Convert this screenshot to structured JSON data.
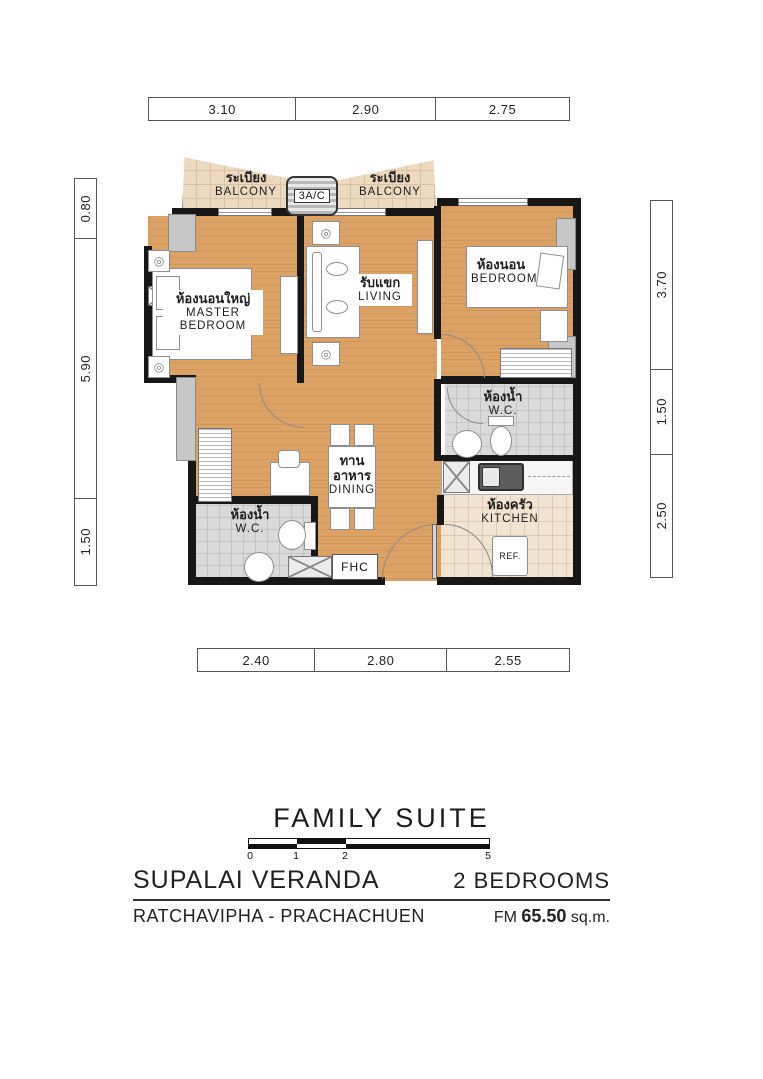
{
  "plan": {
    "rooms": {
      "balcony_left": {
        "thai": "ระเบียง",
        "en": "BALCONY"
      },
      "balcony_right": {
        "thai": "ระเบียง",
        "en": "BALCONY"
      },
      "master_bedroom": {
        "thai": "ห้องนอนใหญ่",
        "en1": "MASTER",
        "en2": "BEDROOM"
      },
      "living": {
        "thai": "รับแขก",
        "en": "LIVING"
      },
      "bedroom": {
        "thai": "ห้องนอน",
        "en": "BEDROOM"
      },
      "wc_upper": {
        "thai": "ห้องน้ำ",
        "en": "W.C."
      },
      "wc_lower": {
        "thai": "ห้องน้ำ",
        "en": "W.C."
      },
      "dining": {
        "thai": "ทานอาหาร",
        "en": "DINING"
      },
      "kitchen": {
        "thai": "ห้องครัว",
        "en": "KITCHEN"
      }
    },
    "labels": {
      "ac": "3A/C",
      "ref": "REF.",
      "fhc": "FHC"
    }
  },
  "dimensions": {
    "top": [
      "3.10",
      "2.90",
      "2.75"
    ],
    "left": [
      "0.80",
      "5.90",
      "1.50"
    ],
    "right": [
      "3.70",
      "1.50",
      "2.50"
    ],
    "bottom": [
      "2.40",
      "2.80",
      "2.55"
    ]
  },
  "scalebar": {
    "ticks": [
      "0",
      "1",
      "2",
      "5"
    ]
  },
  "footer": {
    "title": "FAMILY SUITE",
    "project": "SUPALAI VERANDA",
    "location": "RATCHAVIPHA - PRACHACHUEN",
    "bedrooms": "2 BEDROOMS",
    "area_prefix": "FM",
    "area_value": "65.50",
    "area_unit": "sq.m."
  },
  "colors": {
    "wood_floor": "#DCA265",
    "balcony_tile": "#ECD9C0",
    "wc_tile": "#DADADA",
    "kitchen_tile": "#F1E4D2",
    "wall": "#171717"
  }
}
